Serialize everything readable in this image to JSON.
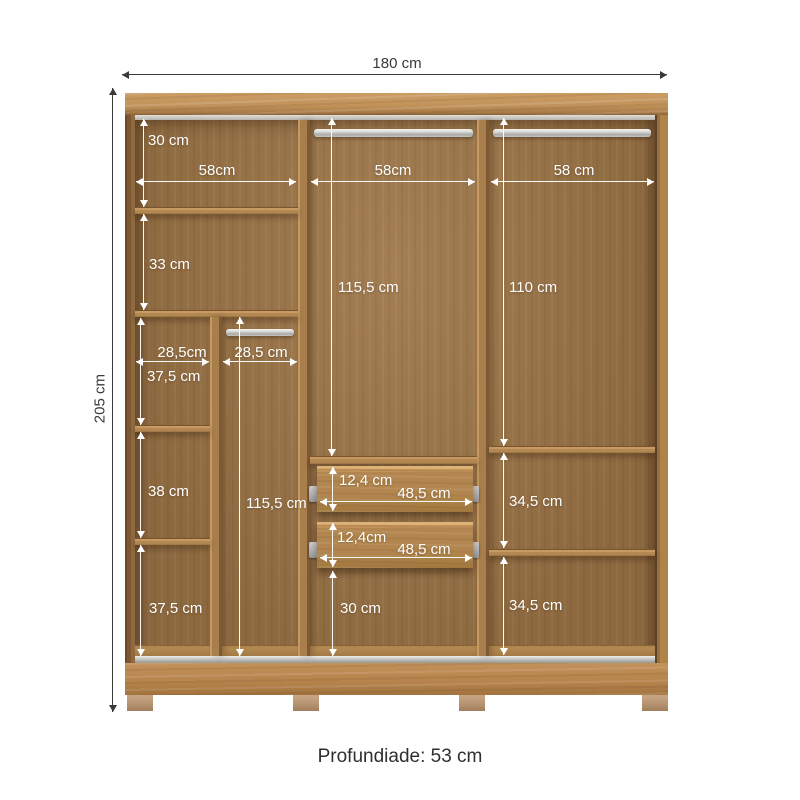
{
  "caption": "Profundiade: 53 cm",
  "outer": {
    "width": "180 cm",
    "height": "205 cm"
  },
  "dims": {
    "left_col_width": "58cm",
    "mid_col_width": "58cm",
    "right_col_width": "58 cm",
    "left_top_section": "30 cm",
    "left_second_section": "33 cm",
    "left_sub_left_width": "28,5cm",
    "left_sub_right_width": "28,5 cm",
    "left_sub_section1": "37,5 cm",
    "left_sub_section2": "38 cm",
    "left_sub_section3": "37,5 cm",
    "left_hang_height": "115,5 cm",
    "mid_hang_height": "115,5 cm",
    "right_hang_height": "110 cm",
    "drawer1_height": "12,4 cm",
    "drawer1_width": "48,5 cm",
    "drawer2_height": "12,4cm",
    "drawer2_width": "48,5 cm",
    "mid_bottom_section": "30 cm",
    "right_section1": "34,5 cm",
    "right_section2": "34,5 cm"
  },
  "colors": {
    "wood_light": "#c2945c",
    "wood_mid": "#a87e4c",
    "wood_back": "#9d7547",
    "dim_line_inner": "#ffffff",
    "dim_line_outer": "#3a3a3a"
  }
}
